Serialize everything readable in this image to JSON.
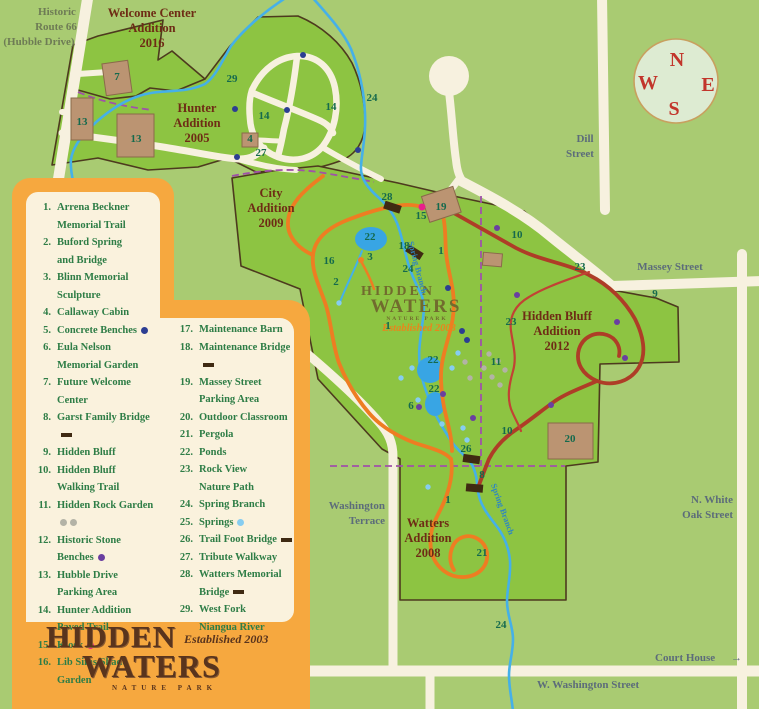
{
  "colors": {
    "background": "#a9cb72",
    "park": "#8dc442",
    "boundary": "#4d3a1e",
    "road": "#f7f1df",
    "stream": "#45b0e8",
    "pond": "#38a5e4",
    "orange_trail": "#ee7d22",
    "red_trail": "#ae3d27",
    "nature_path": "#c24234",
    "purple_dash": "#a052a8",
    "building_tan": "#bb9472",
    "bridge": "#3f2a12",
    "legend_orange": "#f6a83f",
    "legend_cream": "#faf2dd",
    "legend_text": "#2e7d46",
    "map_number": "#156a4d",
    "area_title": "#6e2c15",
    "street_label": "#5c6c7a",
    "compass_letter": "#c2352b",
    "dots": {
      "navy": "#2c3e92",
      "purple": "#6a3fa0",
      "pink": "#e91e8c",
      "ltblue": "#86cdf0",
      "gray": "#b3b3a6",
      "orange": "#f07f24"
    }
  },
  "legend": {
    "col1": [
      {
        "n": 1,
        "label": "Arrena Beckner\nMemorial Trail",
        "marker": null
      },
      {
        "n": 2,
        "label": "Buford Spring\nand Bridge",
        "marker": null
      },
      {
        "n": 3,
        "label": "Blinn Memorial\nSculpture",
        "marker": null
      },
      {
        "n": 4,
        "label": "Callaway Cabin",
        "marker": null
      },
      {
        "n": 5,
        "label": "Concrete Benches",
        "marker": "dot-navy"
      },
      {
        "n": 6,
        "label": "Eula Nelson\nMemorial Garden",
        "marker": null
      },
      {
        "n": 7,
        "label": "Future Welcome\nCenter",
        "marker": null
      },
      {
        "n": 8,
        "label": "Garst Family Bridge",
        "marker": "dash"
      },
      {
        "n": 9,
        "label": "Hidden Bluff",
        "marker": null
      },
      {
        "n": 10,
        "label": "Hidden Bluff\nWalking Trail",
        "marker": null
      },
      {
        "n": 11,
        "label": "Hidden Rock Garden",
        "marker": "dots-gray"
      },
      {
        "n": 12,
        "label": "Historic Stone Benches",
        "marker": "dot-purple"
      },
      {
        "n": 13,
        "label": "Hubble Drive\nParking Area",
        "marker": null
      },
      {
        "n": 14,
        "label": "Hunter Addition\nPaved Trail",
        "marker": null
      },
      {
        "n": 15,
        "label": "Kiosk",
        "marker": "dot-pink"
      },
      {
        "n": 16,
        "label": "Lib Sims Shade Garden",
        "marker": null
      }
    ],
    "col2": [
      {
        "n": 17,
        "label": "Maintenance Barn",
        "marker": null
      },
      {
        "n": 18,
        "label": "Maintenance Bridge",
        "marker": "dash"
      },
      {
        "n": 19,
        "label": "Massey Street\nParking Area",
        "marker": null
      },
      {
        "n": 20,
        "label": "Outdoor Classroom",
        "marker": null
      },
      {
        "n": 21,
        "label": "Pergola",
        "marker": null
      },
      {
        "n": 22,
        "label": "Ponds",
        "marker": null
      },
      {
        "n": 23,
        "label": "Rock View\nNature Path",
        "marker": null
      },
      {
        "n": 24,
        "label": "Spring Branch",
        "marker": null
      },
      {
        "n": 25,
        "label": "Springs",
        "marker": "dot-ltblue"
      },
      {
        "n": 26,
        "label": "Trail Foot Bridge",
        "marker": "dash"
      },
      {
        "n": 27,
        "label": "Tribute Walkway",
        "marker": null
      },
      {
        "n": 28,
        "label": "Watters Memorial\nBridge",
        "marker": "dash"
      },
      {
        "n": 29,
        "label": "West Fork\nNiangua River",
        "marker": null
      }
    ]
  },
  "logo": {
    "line1": "HIDDEN",
    "line2": "WATERS",
    "established": "Established 2003",
    "subtitle": "NATURE PARK"
  },
  "watermark": {
    "line1": "HIDDEN",
    "line2": "WATERS",
    "sub": "NATURE PARK",
    "established": "Established 2003"
  },
  "compass": {
    "n": "N",
    "e": "E",
    "s": "S",
    "w": "W"
  },
  "map": {
    "area_titles": [
      {
        "lines": [
          "Welcome Center",
          "Addition",
          "2016"
        ],
        "x": 152,
        "y": 17
      },
      {
        "lines": [
          "Hunter",
          "Addition",
          "2005"
        ],
        "x": 197,
        "y": 112
      },
      {
        "lines": [
          "City",
          "Addition",
          "2009"
        ],
        "x": 271,
        "y": 197
      },
      {
        "lines": [
          "Hidden Bluff",
          "Addition",
          "2012"
        ],
        "x": 557,
        "y": 320
      },
      {
        "lines": [
          "Watters",
          "Addition",
          "2008"
        ],
        "x": 428,
        "y": 527
      }
    ],
    "street_labels": [
      {
        "t": "Historic",
        "x": 57,
        "y": 15,
        "anchor": "middle",
        "cls": "olive"
      },
      {
        "t": "Route 66",
        "x": 56,
        "y": 30,
        "anchor": "middle",
        "cls": "olive"
      },
      {
        "t": "(Hubble Drive)",
        "x": 39,
        "y": 45,
        "anchor": "middle",
        "cls": "olive"
      },
      {
        "t": "Dill",
        "x": 585,
        "y": 142,
        "anchor": "middle",
        "cls": "street"
      },
      {
        "t": "Street",
        "x": 580,
        "y": 157,
        "anchor": "middle",
        "cls": "street"
      },
      {
        "t": "Massey Street",
        "x": 670,
        "y": 270,
        "anchor": "middle",
        "cls": "street"
      },
      {
        "t": "N. White",
        "x": 733,
        "y": 503,
        "anchor": "end",
        "cls": "street"
      },
      {
        "t": "Oak Street",
        "x": 733,
        "y": 518,
        "anchor": "end",
        "cls": "street"
      },
      {
        "t": "Washington",
        "x": 385,
        "y": 509,
        "anchor": "end",
        "cls": "street"
      },
      {
        "t": "Terrace",
        "x": 385,
        "y": 524,
        "anchor": "end",
        "cls": "street"
      },
      {
        "t": "Court House",
        "x": 655,
        "y": 661,
        "anchor": "start",
        "cls": "street"
      },
      {
        "t": "→",
        "x": 731,
        "y": 661,
        "anchor": "start",
        "cls": "street"
      },
      {
        "t": "W. Washington Street",
        "x": 537,
        "y": 688,
        "anchor": "start",
        "cls": "street"
      },
      {
        "t": "Spring Branch",
        "x": 415,
        "y": 268,
        "anchor": "middle",
        "cls": "stream-lbl",
        "rotate": 75
      },
      {
        "t": "Spring Branch",
        "x": 500,
        "y": 510,
        "anchor": "middle",
        "cls": "stream-lbl",
        "rotate": 70
      }
    ],
    "number_labels": [
      {
        "t": "29",
        "x": 232,
        "y": 82
      },
      {
        "t": "24",
        "x": 372,
        "y": 101
      },
      {
        "t": "24",
        "x": 408,
        "y": 272
      },
      {
        "t": "24",
        "x": 501,
        "y": 628
      },
      {
        "t": "14",
        "x": 264,
        "y": 119
      },
      {
        "t": "14",
        "x": 331,
        "y": 110
      },
      {
        "t": "4",
        "x": 250,
        "y": 142
      },
      {
        "t": "27",
        "x": 261,
        "y": 156
      },
      {
        "t": "7",
        "x": 117,
        "y": 80
      },
      {
        "t": "13",
        "x": 82,
        "y": 125
      },
      {
        "t": "13",
        "x": 136,
        "y": 142
      },
      {
        "t": "28",
        "x": 387,
        "y": 200
      },
      {
        "t": "15",
        "x": 421,
        "y": 219
      },
      {
        "t": "19",
        "x": 441,
        "y": 210
      },
      {
        "t": "22",
        "x": 370,
        "y": 240
      },
      {
        "t": "22",
        "x": 433,
        "y": 363
      },
      {
        "t": "22",
        "x": 434,
        "y": 392
      },
      {
        "t": "18",
        "x": 404,
        "y": 249
      },
      {
        "t": "1",
        "x": 441,
        "y": 254
      },
      {
        "t": "1",
        "x": 388,
        "y": 329
      },
      {
        "t": "1",
        "x": 448,
        "y": 503
      },
      {
        "t": "16",
        "x": 329,
        "y": 264
      },
      {
        "t": "2",
        "x": 336,
        "y": 285
      },
      {
        "t": "3",
        "x": 370,
        "y": 260
      },
      {
        "t": "6",
        "x": 411,
        "y": 409
      },
      {
        "t": "26",
        "x": 466,
        "y": 452
      },
      {
        "t": "8",
        "x": 482,
        "y": 478
      },
      {
        "t": "21",
        "x": 482,
        "y": 556
      },
      {
        "t": "20",
        "x": 570,
        "y": 442
      },
      {
        "t": "10",
        "x": 517,
        "y": 238
      },
      {
        "t": "10",
        "x": 507,
        "y": 434
      },
      {
        "t": "23",
        "x": 580,
        "y": 270
      },
      {
        "t": "23",
        "x": 511,
        "y": 325
      },
      {
        "t": "9",
        "x": 655,
        "y": 297
      },
      {
        "t": "11",
        "x": 496,
        "y": 365
      }
    ],
    "dots": [
      {
        "c": "navy",
        "x": 303,
        "y": 55
      },
      {
        "c": "navy",
        "x": 235,
        "y": 109
      },
      {
        "c": "navy",
        "x": 287,
        "y": 110
      },
      {
        "c": "navy",
        "x": 237,
        "y": 157
      },
      {
        "c": "navy",
        "x": 358,
        "y": 150
      },
      {
        "c": "navy",
        "x": 448,
        "y": 288
      },
      {
        "c": "navy",
        "x": 462,
        "y": 331
      },
      {
        "c": "navy",
        "x": 467,
        "y": 340
      },
      {
        "c": "purple",
        "x": 497,
        "y": 228
      },
      {
        "c": "purple",
        "x": 517,
        "y": 295
      },
      {
        "c": "purple",
        "x": 617,
        "y": 322
      },
      {
        "c": "purple",
        "x": 625,
        "y": 358
      },
      {
        "c": "purple",
        "x": 551,
        "y": 405
      },
      {
        "c": "purple",
        "x": 443,
        "y": 394
      },
      {
        "c": "purple",
        "x": 473,
        "y": 418
      },
      {
        "c": "purple",
        "x": 419,
        "y": 407
      },
      {
        "c": "pink",
        "x": 422,
        "y": 207
      },
      {
        "c": "orange",
        "x": 361,
        "y": 260
      },
      {
        "c": "ltblue",
        "x": 339,
        "y": 303
      },
      {
        "c": "ltblue",
        "x": 458,
        "y": 353
      },
      {
        "c": "ltblue",
        "x": 412,
        "y": 368
      },
      {
        "c": "ltblue",
        "x": 401,
        "y": 378
      },
      {
        "c": "ltblue",
        "x": 418,
        "y": 400
      },
      {
        "c": "ltblue",
        "x": 442,
        "y": 424
      },
      {
        "c": "ltblue",
        "x": 463,
        "y": 428
      },
      {
        "c": "ltblue",
        "x": 467,
        "y": 440
      },
      {
        "c": "ltblue",
        "x": 428,
        "y": 487
      },
      {
        "c": "ltblue",
        "x": 452,
        "y": 368
      },
      {
        "c": "gray",
        "x": 489,
        "y": 354
      },
      {
        "c": "gray",
        "x": 498,
        "y": 361
      },
      {
        "c": "gray",
        "x": 505,
        "y": 370
      },
      {
        "c": "gray",
        "x": 492,
        "y": 377
      },
      {
        "c": "gray",
        "x": 500,
        "y": 385
      },
      {
        "c": "gray",
        "x": 484,
        "y": 368
      },
      {
        "c": "gray",
        "x": 470,
        "y": 378
      },
      {
        "c": "gray",
        "x": 465,
        "y": 362
      }
    ]
  }
}
